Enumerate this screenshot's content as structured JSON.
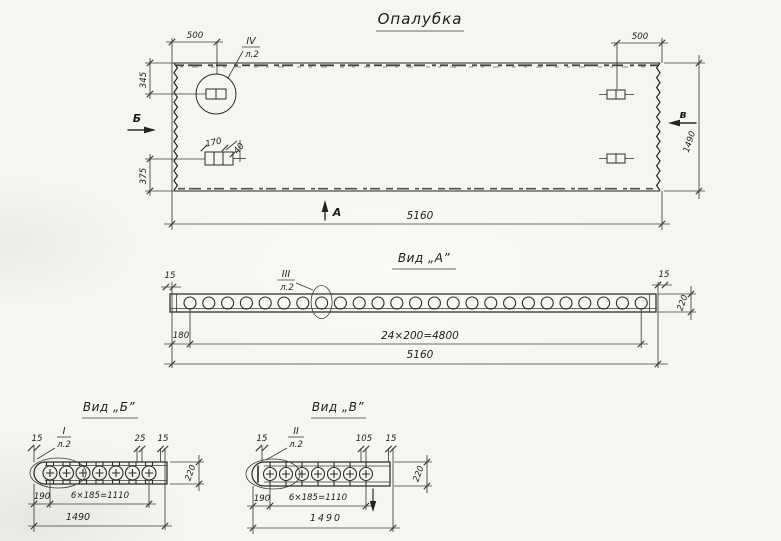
{
  "drawing": {
    "title": "Опалубка",
    "ink_color": "#2b2b2b",
    "paper_color": "#f6f5f1",
    "main_view": {
      "dim_top_left": "500",
      "dim_top_right": "500",
      "dim_left_upper": "345",
      "dim_left_lower": "375",
      "dim_bottom_total": "5160",
      "dim_right_height": "1490",
      "detail_dim_width": "170",
      "detail_dim_height": "40",
      "callout_num": "IV",
      "callout_sheet": "л.2",
      "view_letter_b": "Б",
      "view_letter_v": "в",
      "view_letter_a": "А"
    },
    "view_a": {
      "title": "Вид „А”",
      "callout_num": "III",
      "callout_sheet": "л.2",
      "dim_left": "15",
      "dim_right": "15",
      "dim_height": "220",
      "dim_offset": "180",
      "dim_spacing": "24×200=4800",
      "dim_total": "5160"
    },
    "view_b": {
      "title": "Вид „Б”",
      "callout_num": "I",
      "callout_sheet": "л.2",
      "dim_left": "15",
      "dim_mid": "25",
      "dim_right": "15",
      "dim_height": "220",
      "dim_offset": "190",
      "dim_spacing": "6×185=1110",
      "dim_total": "1490"
    },
    "view_v": {
      "title": "Вид „В”",
      "callout_num": "II",
      "callout_sheet": "л.2",
      "dim_left": "15",
      "dim_mid": "105",
      "dim_right": "15",
      "dim_height": "220",
      "dim_offset": "190",
      "dim_spacing": "6×185=1110",
      "dim_total": "1490"
    }
  }
}
